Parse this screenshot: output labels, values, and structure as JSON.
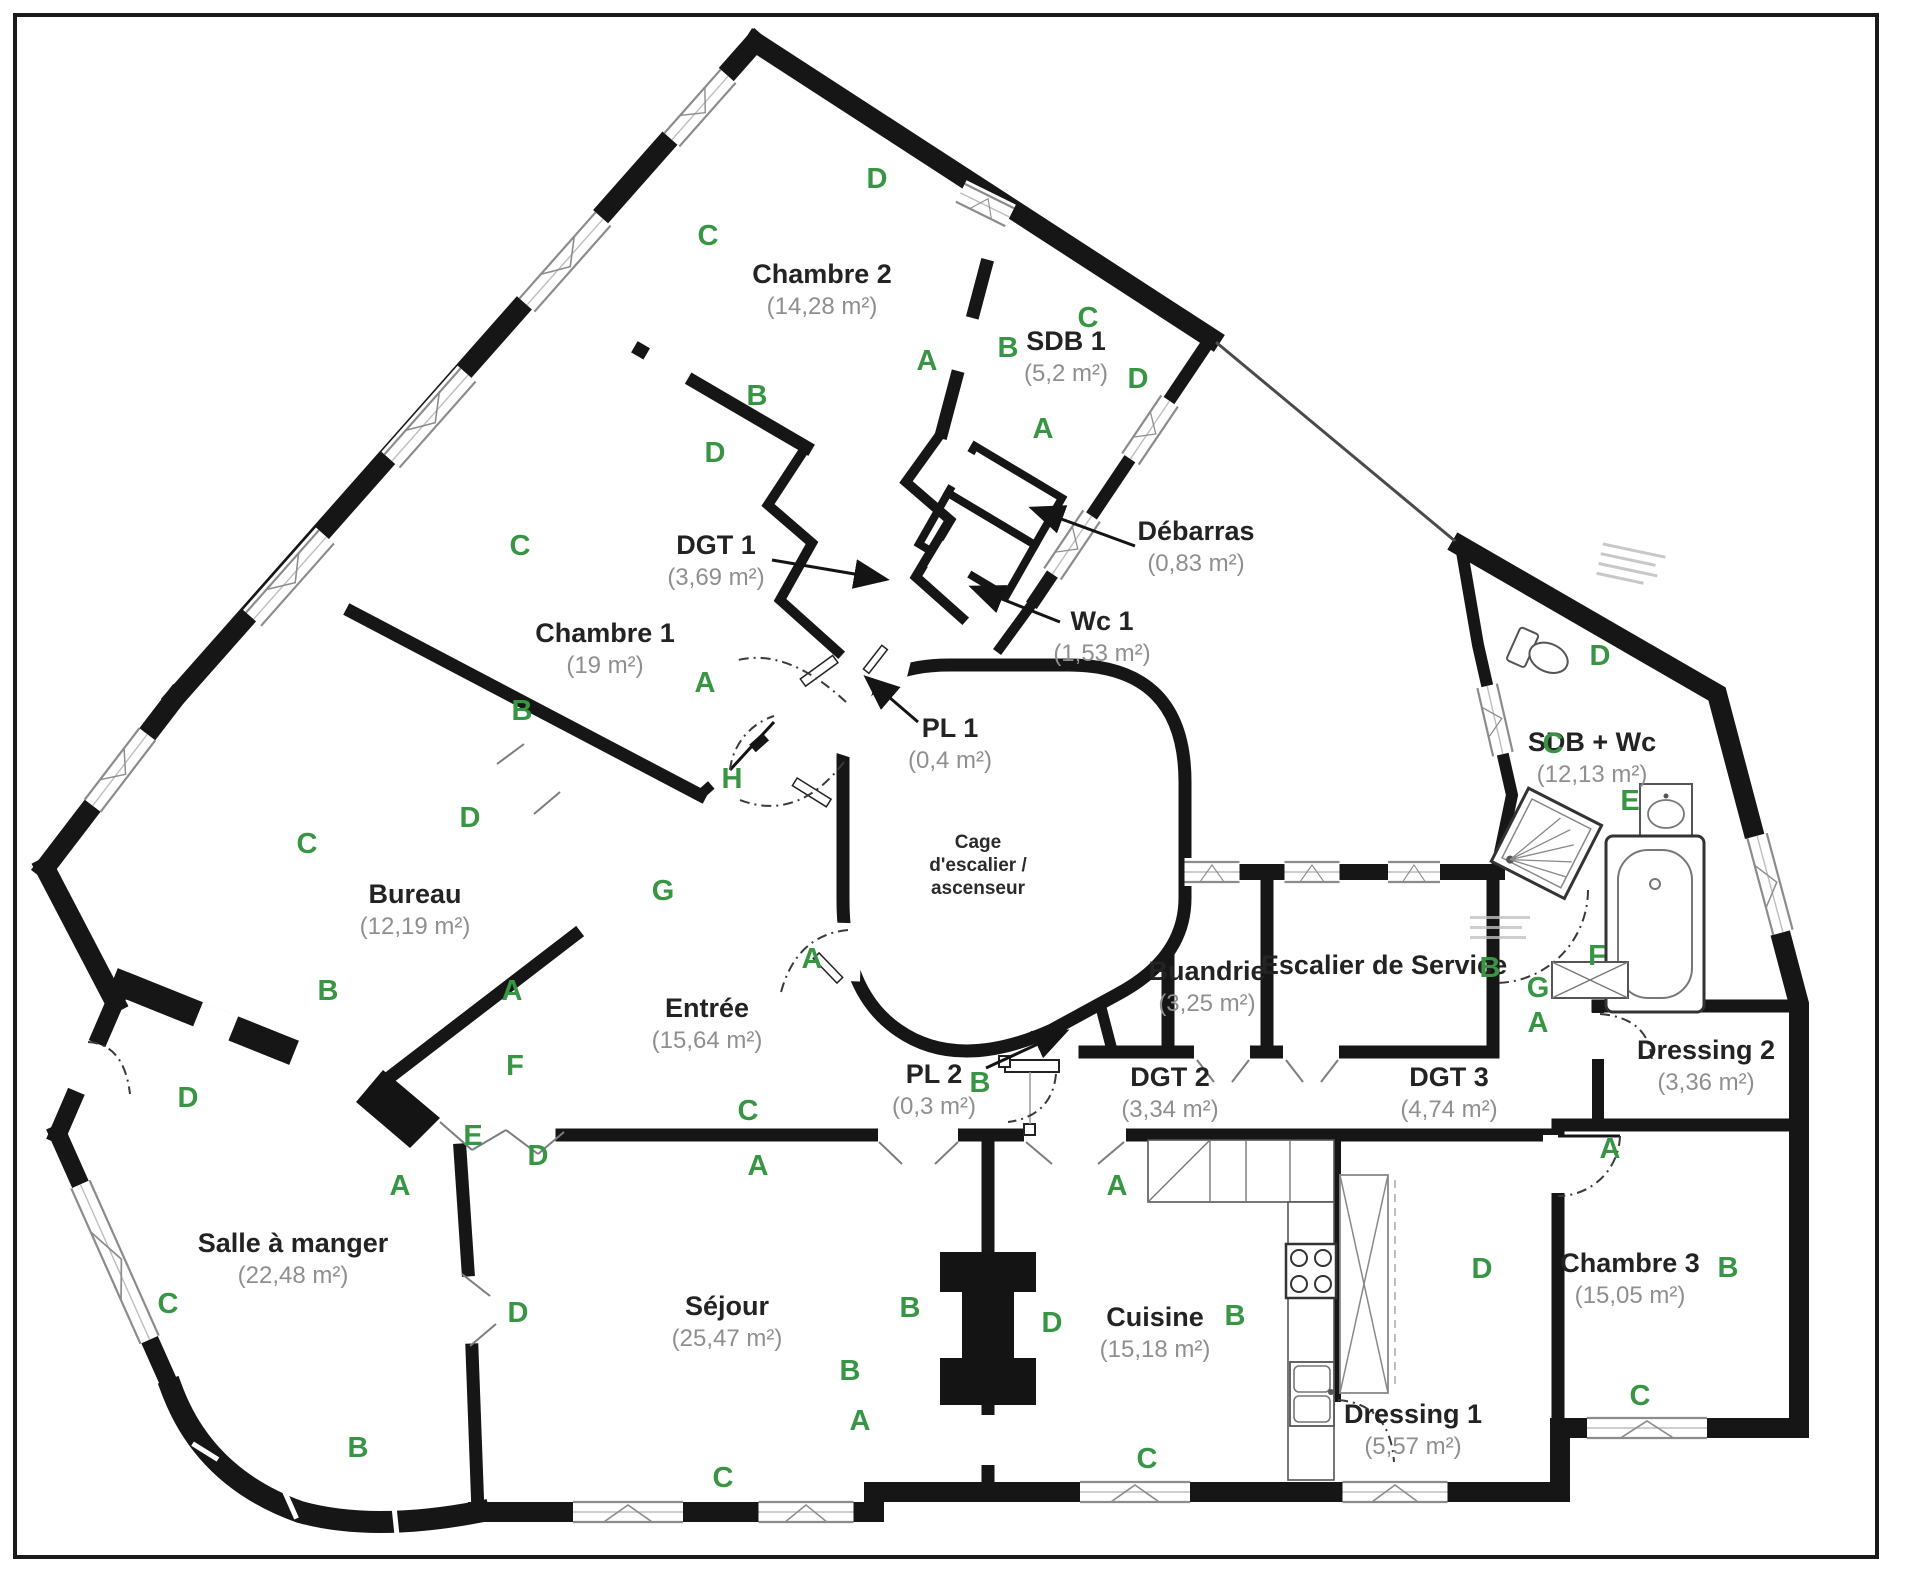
{
  "figure_type": "apartment-floor-plan",
  "units": "m²",
  "colors": {
    "wall": "#161616",
    "orientation_letter": "#379544",
    "room_name_text": "#232323",
    "room_area_text": "#8f8f8f",
    "background": "#ffffff"
  },
  "rooms": [
    {
      "id": "chambre-2",
      "name": "Chambre 2",
      "area": "(14,28 m²)",
      "x": 822,
      "y": 283
    },
    {
      "id": "sdb-1",
      "name": "SDB 1",
      "area": "(5,2 m²)",
      "x": 1066,
      "y": 350
    },
    {
      "id": "debarras",
      "name": "Débarras",
      "area": "(0,83 m²)",
      "x": 1196,
      "y": 540
    },
    {
      "id": "wc-1",
      "name": "Wc 1",
      "area": "(1,53 m²)",
      "x": 1102,
      "y": 630
    },
    {
      "id": "pl-1",
      "name": "PL 1",
      "area": "(0,4 m²)",
      "x": 950,
      "y": 737
    },
    {
      "id": "dgt-1",
      "name": "DGT 1",
      "area": "(3,69 m²)",
      "x": 716,
      "y": 554
    },
    {
      "id": "chambre-1",
      "name": "Chambre 1",
      "area": "(19 m²)",
      "x": 605,
      "y": 642
    },
    {
      "id": "bureau",
      "name": "Bureau",
      "area": "(12,19 m²)",
      "x": 415,
      "y": 903
    },
    {
      "id": "cage-escalier-ascenseur",
      "lines": [
        "Cage",
        "d'escalier /",
        "ascenseur"
      ],
      "x": 978,
      "y": 848
    },
    {
      "id": "entree",
      "name": "Entrée",
      "area": "(15,64 m²)",
      "x": 707,
      "y": 1017
    },
    {
      "id": "buandrie",
      "name": "Buandrie",
      "area": "(3,25 m²)",
      "x": 1207,
      "y": 980
    },
    {
      "id": "escalier-de-service",
      "name": "Escalier de Service",
      "area": "",
      "x": 1384,
      "y": 974
    },
    {
      "id": "sdb-wc",
      "name": "SDB + Wc",
      "area": "(12,13 m²)",
      "x": 1592,
      "y": 751
    },
    {
      "id": "dressing-2",
      "name": "Dressing 2",
      "area": "(3,36 m²)",
      "x": 1706,
      "y": 1059
    },
    {
      "id": "dgt-3",
      "name": "DGT 3",
      "area": "(4,74 m²)",
      "x": 1449,
      "y": 1086
    },
    {
      "id": "dgt-2",
      "name": "DGT 2",
      "area": "(3,34 m²)",
      "x": 1170,
      "y": 1086
    },
    {
      "id": "pl-2",
      "name": "PL 2",
      "area": "(0,3 m²)",
      "x": 934,
      "y": 1083
    },
    {
      "id": "salle-a-manger",
      "name": "Salle à manger",
      "area": "(22,48 m²)",
      "x": 293,
      "y": 1252
    },
    {
      "id": "sejour",
      "name": "Séjour",
      "area": "(25,47 m²)",
      "x": 727,
      "y": 1315
    },
    {
      "id": "cuisine",
      "name": "Cuisine",
      "area": "(15,18 m²)",
      "x": 1155,
      "y": 1326
    },
    {
      "id": "dressing-1",
      "name": "Dressing 1",
      "area": "(5,57 m²)",
      "x": 1413,
      "y": 1423
    },
    {
      "id": "chambre-3",
      "name": "Chambre 3",
      "area": "(15,05 m²)",
      "x": 1630,
      "y": 1272
    }
  ],
  "orientation_letters": [
    {
      "t": "D",
      "x": 877,
      "y": 188
    },
    {
      "t": "C",
      "x": 708,
      "y": 245
    },
    {
      "t": "A",
      "x": 927,
      "y": 370
    },
    {
      "t": "B",
      "x": 757,
      "y": 405
    },
    {
      "t": "B",
      "x": 1008,
      "y": 357
    },
    {
      "t": "C",
      "x": 1088,
      "y": 327
    },
    {
      "t": "D",
      "x": 1138,
      "y": 388
    },
    {
      "t": "A",
      "x": 1043,
      "y": 438
    },
    {
      "t": "D",
      "x": 715,
      "y": 462
    },
    {
      "t": "C",
      "x": 520,
      "y": 555
    },
    {
      "t": "B",
      "x": 522,
      "y": 720
    },
    {
      "t": "A",
      "x": 705,
      "y": 692
    },
    {
      "t": "H",
      "x": 732,
      "y": 788
    },
    {
      "t": "D",
      "x": 470,
      "y": 827
    },
    {
      "t": "C",
      "x": 307,
      "y": 853
    },
    {
      "t": "G",
      "x": 663,
      "y": 900
    },
    {
      "t": "B",
      "x": 328,
      "y": 1000
    },
    {
      "t": "A",
      "x": 512,
      "y": 1000
    },
    {
      "t": "F",
      "x": 515,
      "y": 1075
    },
    {
      "t": "E",
      "x": 473,
      "y": 1145
    },
    {
      "t": "D",
      "x": 538,
      "y": 1165
    },
    {
      "t": "A",
      "x": 400,
      "y": 1195
    },
    {
      "t": "A",
      "x": 812,
      "y": 968
    },
    {
      "t": "C",
      "x": 748,
      "y": 1120
    },
    {
      "t": "A",
      "x": 758,
      "y": 1175
    },
    {
      "t": "D",
      "x": 188,
      "y": 1107
    },
    {
      "t": "C",
      "x": 168,
      "y": 1313
    },
    {
      "t": "B",
      "x": 358,
      "y": 1457
    },
    {
      "t": "D",
      "x": 518,
      "y": 1322
    },
    {
      "t": "B",
      "x": 910,
      "y": 1317
    },
    {
      "t": "B",
      "x": 850,
      "y": 1380
    },
    {
      "t": "A",
      "x": 860,
      "y": 1430
    },
    {
      "t": "C",
      "x": 723,
      "y": 1487
    },
    {
      "t": "B",
      "x": 980,
      "y": 1092
    },
    {
      "t": "A",
      "x": 1117,
      "y": 1195
    },
    {
      "t": "B",
      "x": 1235,
      "y": 1325
    },
    {
      "t": "D",
      "x": 1052,
      "y": 1332
    },
    {
      "t": "C",
      "x": 1147,
      "y": 1468
    },
    {
      "t": "B",
      "x": 1490,
      "y": 977
    },
    {
      "t": "G",
      "x": 1538,
      "y": 997
    },
    {
      "t": "A",
      "x": 1538,
      "y": 1032
    },
    {
      "t": "D",
      "x": 1600,
      "y": 665
    },
    {
      "t": "C",
      "x": 1553,
      "y": 753
    },
    {
      "t": "E",
      "x": 1630,
      "y": 810
    },
    {
      "t": "F",
      "x": 1597,
      "y": 965
    },
    {
      "t": "A",
      "x": 1610,
      "y": 1158
    },
    {
      "t": "D",
      "x": 1482,
      "y": 1278
    },
    {
      "t": "B",
      "x": 1728,
      "y": 1277
    },
    {
      "t": "C",
      "x": 1640,
      "y": 1405
    }
  ]
}
